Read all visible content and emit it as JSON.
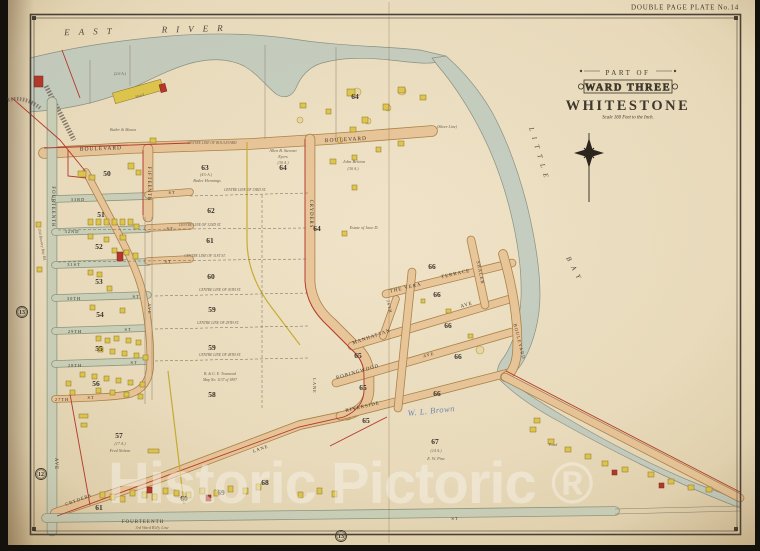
{
  "plate_label": "DOUBLE PAGE PLATE No.14",
  "title": {
    "part_of": "PART OF",
    "ward": "WARD THREE",
    "place": "WHITESTONE",
    "scale": "Scale 160 Feet to the Inch."
  },
  "water_labels": {
    "river": "EAST RIVER",
    "bay_word1": "LITTLE",
    "bay_word2": "BAY"
  },
  "annotation": {
    "handwriting": "W. L. Brown"
  },
  "watermark": "Historic Pictoric ®",
  "page_refs": [
    {
      "n": "13",
      "x": 22,
      "y": 312
    },
    {
      "n": "12",
      "x": 41,
      "y": 474
    },
    {
      "n": "13",
      "x": 341,
      "y": 536
    }
  ],
  "street_labels": [
    {
      "t": "BOULEVARD",
      "x": 101,
      "y": 150,
      "r": -2,
      "s": 5.5,
      "ls": 1.5
    },
    {
      "t": "BOULEVARD",
      "x": 346,
      "y": 141,
      "r": -3,
      "s": 5.5,
      "ls": 1.5
    },
    {
      "t": "FOURTEENTH",
      "x": 52,
      "y": 207,
      "r": 90,
      "s": 4.8
    },
    {
      "t": "AVE",
      "x": 55,
      "y": 464,
      "r": 90,
      "s": 4.8
    },
    {
      "t": "FIFTEENTH",
      "x": 148,
      "y": 184,
      "r": 90,
      "s": 4.8
    },
    {
      "t": "AVE",
      "x": 148,
      "y": 309,
      "r": 90,
      "s": 4.4
    },
    {
      "t": "CRYDERS",
      "x": 310,
      "y": 214,
      "r": 90,
      "s": 4.8
    },
    {
      "t": "LANE",
      "x": 313,
      "y": 386,
      "r": 90,
      "s": 4.4
    },
    {
      "t": "33RD",
      "x": 78,
      "y": 201,
      "s": 4.4
    },
    {
      "t": "ST",
      "x": 172,
      "y": 194,
      "s": 4.4
    },
    {
      "t": "32ND",
      "x": 72,
      "y": 233,
      "s": 4.4
    },
    {
      "t": "ST",
      "x": 170,
      "y": 230,
      "s": 4.4
    },
    {
      "t": "31ST",
      "x": 74,
      "y": 266,
      "s": 4.4
    },
    {
      "t": "ST",
      "x": 168,
      "y": 263,
      "s": 4.4
    },
    {
      "t": "30TH",
      "x": 74,
      "y": 300,
      "s": 4.4
    },
    {
      "t": "ST",
      "x": 136,
      "y": 298,
      "s": 4.4
    },
    {
      "t": "29TH",
      "x": 75,
      "y": 333,
      "s": 4.4
    },
    {
      "t": "ST",
      "x": 128,
      "y": 331,
      "s": 4.4
    },
    {
      "t": "28TH",
      "x": 75,
      "y": 367,
      "s": 4.4
    },
    {
      "t": "ST",
      "x": 134,
      "y": 364,
      "s": 4.4
    },
    {
      "t": "27TH",
      "x": 62,
      "y": 401,
      "s": 4.4
    },
    {
      "t": "ST",
      "x": 91,
      "y": 399,
      "s": 4.4
    },
    {
      "t": "FOURTEENTH",
      "x": 143,
      "y": 523,
      "s": 5,
      "ls": 1.5
    },
    {
      "t": "ST",
      "x": 455,
      "y": 520,
      "s": 4.6
    },
    {
      "t": "THE VERA",
      "x": 406,
      "y": 289,
      "r": -13
    },
    {
      "t": "TERRACE",
      "x": 456,
      "y": 275,
      "r": -13
    },
    {
      "t": "MANHATTAN",
      "x": 372,
      "y": 338,
      "r": -19
    },
    {
      "t": "AVE",
      "x": 467,
      "y": 306,
      "r": -17
    },
    {
      "t": "ROBINGWOOD",
      "x": 358,
      "y": 373,
      "r": -16
    },
    {
      "t": "AVE",
      "x": 429,
      "y": 356,
      "r": -16,
      "s": 4.4
    },
    {
      "t": "RIVERSIDE",
      "x": 363,
      "y": 408,
      "r": -13
    },
    {
      "t": "SHALER",
      "x": 479,
      "y": 273,
      "r": 78,
      "s": 4.6
    },
    {
      "t": "BOULEVARD",
      "x": 518,
      "y": 342,
      "r": 76,
      "s": 4.6
    },
    {
      "t": "26TH",
      "x": 388,
      "y": 307,
      "r": 78,
      "s": 4.2
    },
    {
      "t": "LANE",
      "x": 261,
      "y": 450,
      "r": -19,
      "s": 4.6
    },
    {
      "t": "CRYDERS",
      "x": 79,
      "y": 501,
      "r": -20,
      "s": 4.6
    }
  ],
  "block_labels": [
    {
      "n": "50",
      "x": 107,
      "y": 176
    },
    {
      "n": "51",
      "x": 101,
      "y": 217
    },
    {
      "n": "52",
      "x": 99,
      "y": 249
    },
    {
      "n": "53",
      "x": 99,
      "y": 284
    },
    {
      "n": "54",
      "x": 100,
      "y": 317
    },
    {
      "n": "55",
      "x": 99,
      "y": 351
    },
    {
      "n": "56",
      "x": 96,
      "y": 386
    },
    {
      "n": "57",
      "x": 119,
      "y": 438
    },
    {
      "n": "58",
      "x": 212,
      "y": 397
    },
    {
      "n": "59",
      "x": 212,
      "y": 350
    },
    {
      "n": "59",
      "x": 212,
      "y": 312
    },
    {
      "n": "60",
      "x": 211,
      "y": 279
    },
    {
      "n": "61",
      "x": 210,
      "y": 243
    },
    {
      "n": "62",
      "x": 211,
      "y": 213
    },
    {
      "n": "63",
      "x": 205,
      "y": 170
    },
    {
      "n": "64",
      "x": 283,
      "y": 170
    },
    {
      "n": "64",
      "x": 355,
      "y": 99
    },
    {
      "n": "64",
      "x": 317,
      "y": 231
    },
    {
      "n": "65",
      "x": 358,
      "y": 358
    },
    {
      "n": "65",
      "x": 363,
      "y": 390
    },
    {
      "n": "65",
      "x": 366,
      "y": 423
    },
    {
      "n": "66",
      "x": 432,
      "y": 269
    },
    {
      "n": "66",
      "x": 437,
      "y": 297
    },
    {
      "n": "66",
      "x": 448,
      "y": 328
    },
    {
      "n": "66",
      "x": 458,
      "y": 359
    },
    {
      "n": "66",
      "x": 437,
      "y": 396
    },
    {
      "n": "67",
      "x": 435,
      "y": 444
    },
    {
      "n": "68",
      "x": 265,
      "y": 485
    },
    {
      "n": "69",
      "x": 221,
      "y": 495
    },
    {
      "n": "60",
      "x": 184,
      "y": 501
    },
    {
      "n": "61",
      "x": 99,
      "y": 510
    }
  ],
  "notes": [
    {
      "t": "CENTRE LINE OF BOULEVARD",
      "x": 212,
      "y": 144,
      "s": 3.6
    },
    {
      "t": "CENTRE LINE OF 33RD ST.",
      "x": 245,
      "y": 191,
      "s": 3.6
    },
    {
      "t": "CENTRE LINE OF 32ND ST.",
      "x": 200,
      "y": 226,
      "s": 3.6
    },
    {
      "t": "CENTRE LINE OF 31ST ST.",
      "x": 205,
      "y": 257,
      "s": 3.6
    },
    {
      "t": "CENTRE LINE OF 30TH ST.",
      "x": 220,
      "y": 291,
      "s": 3.6
    },
    {
      "t": "CENTRE LINE OF 29TH ST.",
      "x": 218,
      "y": 324,
      "s": 3.6
    },
    {
      "t": "CENTRE LINE OF 28TH ST.",
      "x": 220,
      "y": 356,
      "s": 3.6
    },
    {
      "t": "(Shore Line)",
      "x": 447,
      "y": 128,
      "s": 4
    },
    {
      "t": "John Britton",
      "x": 354,
      "y": 163,
      "s": 4.5
    },
    {
      "t": "(30 A.)",
      "x": 353,
      "y": 170,
      "s": 4
    },
    {
      "t": "Allen B. Stewart",
      "x": 283,
      "y": 152,
      "s": 4.2
    },
    {
      "t": "Eyers",
      "x": 283,
      "y": 158,
      "s": 4.2
    },
    {
      "t": "(30 A.)",
      "x": 283,
      "y": 164,
      "s": 4
    },
    {
      "t": "(4½ A.)",
      "x": 206,
      "y": 176,
      "s": 4
    },
    {
      "t": "Butler Hennings",
      "x": 207,
      "y": 182,
      "s": 4.2
    },
    {
      "t": "(17 A.)",
      "x": 120,
      "y": 445,
      "s": 4
    },
    {
      "t": "Fred Nelson",
      "x": 120,
      "y": 452,
      "s": 4.2
    },
    {
      "t": "(14 A.)",
      "x": 436,
      "y": 452,
      "s": 4
    },
    {
      "t": "E. W. Pine",
      "x": 436,
      "y": 460,
      "s": 4.2
    },
    {
      "t": "Estate of Jane D.",
      "x": 364,
      "y": 229,
      "s": 4.2
    },
    {
      "t": "(2.6 A.)",
      "x": 120,
      "y": 75,
      "s": 4
    },
    {
      "t": "Hotel",
      "x": 140,
      "y": 97,
      "s": 4,
      "r": -17
    },
    {
      "t": "3rd Ward B'd'y Line",
      "x": 152,
      "y": 529,
      "s": 4.2
    },
    {
      "t": "Butler & Mason",
      "x": 123,
      "y": 131,
      "s": 4
    },
    {
      "t": "B. & G. E. Townsend",
      "x": 220,
      "y": 375,
      "s": 3.8
    },
    {
      "t": "Map No. 1137 of 1897",
      "x": 220,
      "y": 381,
      "s": 3.8
    },
    {
      "t": "Pond",
      "x": 553,
      "y": 446,
      "s": 4
    },
    {
      "t": "Old Bowery Bay Rd.",
      "x": 41,
      "y": 245,
      "s": 4,
      "r": 80
    }
  ],
  "buildings": [
    [
      113,
      86,
      50,
      11,
      "y",
      -16
    ],
    [
      34,
      76,
      9,
      11,
      "r"
    ],
    [
      160,
      84,
      6,
      8,
      "r",
      -15
    ],
    [
      78,
      171,
      8,
      6,
      "y"
    ],
    [
      89,
      175,
      6,
      5,
      "y"
    ],
    [
      128,
      163,
      6,
      6,
      "y"
    ],
    [
      136,
      170,
      5,
      5,
      "y"
    ],
    [
      150,
      138,
      6,
      5,
      "y"
    ],
    [
      88,
      219,
      5,
      6,
      "y"
    ],
    [
      96,
      219,
      5,
      6,
      "y"
    ],
    [
      104,
      219,
      5,
      6,
      "y"
    ],
    [
      112,
      219,
      5,
      6,
      "y"
    ],
    [
      120,
      219,
      5,
      6,
      "y"
    ],
    [
      128,
      219,
      5,
      6,
      "y"
    ],
    [
      134,
      224,
      5,
      5,
      "y"
    ],
    [
      88,
      234,
      5,
      5,
      "y"
    ],
    [
      104,
      237,
      5,
      5,
      "y"
    ],
    [
      120,
      235,
      6,
      5,
      "y"
    ],
    [
      112,
      248,
      5,
      5,
      "y"
    ],
    [
      124,
      250,
      5,
      5,
      "y"
    ],
    [
      133,
      253,
      5,
      6,
      "y"
    ],
    [
      117,
      252,
      6,
      9,
      "r"
    ],
    [
      88,
      270,
      5,
      5,
      "y"
    ],
    [
      97,
      272,
      5,
      5,
      "y"
    ],
    [
      107,
      286,
      5,
      5,
      "y"
    ],
    [
      90,
      305,
      5,
      5,
      "y"
    ],
    [
      120,
      308,
      5,
      5,
      "y"
    ],
    [
      96,
      336,
      5,
      5,
      "y"
    ],
    [
      105,
      338,
      5,
      5,
      "y"
    ],
    [
      114,
      336,
      5,
      5,
      "y"
    ],
    [
      126,
      338,
      5,
      5,
      "y"
    ],
    [
      136,
      340,
      5,
      5,
      "y"
    ],
    [
      98,
      347,
      5,
      5,
      "y"
    ],
    [
      110,
      349,
      5,
      5,
      "y"
    ],
    [
      122,
      351,
      5,
      5,
      "y"
    ],
    [
      134,
      353,
      5,
      5,
      "y"
    ],
    [
      143,
      355,
      5,
      5,
      "y"
    ],
    [
      80,
      372,
      5,
      5,
      "y"
    ],
    [
      92,
      374,
      5,
      5,
      "y"
    ],
    [
      104,
      376,
      5,
      5,
      "y"
    ],
    [
      116,
      378,
      5,
      5,
      "y"
    ],
    [
      128,
      380,
      5,
      5,
      "y"
    ],
    [
      140,
      382,
      5,
      5,
      "y"
    ],
    [
      96,
      388,
      5,
      5,
      "y"
    ],
    [
      110,
      390,
      5,
      5,
      "y"
    ],
    [
      124,
      392,
      5,
      5,
      "y"
    ],
    [
      138,
      394,
      5,
      5,
      "y"
    ],
    [
      66,
      381,
      5,
      5,
      "y"
    ],
    [
      70,
      390,
      5,
      5,
      "y"
    ],
    [
      79,
      414,
      9,
      4,
      "y"
    ],
    [
      81,
      423,
      6,
      4,
      "y"
    ],
    [
      148,
      449,
      11,
      4,
      "y"
    ],
    [
      100,
      492,
      5,
      6,
      "y"
    ],
    [
      110,
      494,
      5,
      6,
      "y"
    ],
    [
      120,
      496,
      5,
      6,
      "y"
    ],
    [
      130,
      490,
      5,
      6,
      "y"
    ],
    [
      142,
      492,
      5,
      6,
      "y"
    ],
    [
      152,
      494,
      5,
      6,
      "y"
    ],
    [
      163,
      488,
      5,
      6,
      "y"
    ],
    [
      174,
      490,
      5,
      6,
      "y"
    ],
    [
      186,
      492,
      5,
      6,
      "y"
    ],
    [
      200,
      488,
      5,
      6,
      "y"
    ],
    [
      214,
      490,
      5,
      6,
      "y"
    ],
    [
      228,
      486,
      5,
      6,
      "y"
    ],
    [
      243,
      488,
      5,
      6,
      "y"
    ],
    [
      256,
      484,
      5,
      6,
      "y"
    ],
    [
      147,
      487,
      5,
      6,
      "r"
    ],
    [
      206,
      495,
      5,
      6,
      "r"
    ],
    [
      298,
      492,
      5,
      6,
      "y"
    ],
    [
      317,
      488,
      5,
      6,
      "y"
    ],
    [
      332,
      491,
      5,
      6,
      "y"
    ],
    [
      347,
      89,
      8,
      7,
      "y"
    ],
    [
      362,
      117,
      6,
      6,
      "y"
    ],
    [
      398,
      87,
      7,
      6,
      "y"
    ],
    [
      420,
      95,
      6,
      5,
      "y"
    ],
    [
      383,
      104,
      6,
      6,
      "y"
    ],
    [
      326,
      109,
      5,
      5,
      "y"
    ],
    [
      300,
      103,
      6,
      5,
      "y"
    ],
    [
      350,
      127,
      6,
      5,
      "y"
    ],
    [
      330,
      159,
      6,
      5,
      "y"
    ],
    [
      352,
      155,
      5,
      5,
      "y"
    ],
    [
      376,
      147,
      5,
      5,
      "y"
    ],
    [
      398,
      141,
      6,
      5,
      "y"
    ],
    [
      352,
      185,
      5,
      5,
      "y"
    ],
    [
      342,
      231,
      5,
      5,
      "y"
    ],
    [
      446,
      309,
      5,
      4,
      "y"
    ],
    [
      468,
      334,
      5,
      4,
      "y"
    ],
    [
      421,
      299,
      4,
      4,
      "y"
    ],
    [
      530,
      427,
      6,
      5,
      "y"
    ],
    [
      548,
      439,
      6,
      5,
      "y"
    ],
    [
      565,
      447,
      6,
      5,
      "y"
    ],
    [
      585,
      454,
      6,
      5,
      "y"
    ],
    [
      602,
      461,
      6,
      5,
      "y"
    ],
    [
      622,
      467,
      6,
      5,
      "y"
    ],
    [
      648,
      472,
      6,
      5,
      "y"
    ],
    [
      668,
      479,
      6,
      5,
      "y"
    ],
    [
      688,
      485,
      6,
      5,
      "y"
    ],
    [
      612,
      470,
      5,
      5,
      "r"
    ],
    [
      659,
      483,
      5,
      5,
      "r"
    ],
    [
      534,
      418,
      6,
      5,
      "y"
    ],
    [
      706,
      487,
      6,
      5,
      "y"
    ],
    [
      36,
      222,
      5,
      5,
      "y"
    ],
    [
      37,
      267,
      5,
      5,
      "y"
    ]
  ],
  "trees": [
    [
      357,
      92,
      4
    ],
    [
      402,
      91,
      4
    ],
    [
      368,
      121,
      3
    ],
    [
      388,
      108,
      3
    ],
    [
      480,
      350,
      4
    ],
    [
      300,
      120,
      3
    ],
    [
      340,
      140,
      3
    ]
  ],
  "colors": {
    "water": "#c6cfc2",
    "road": "#e9c79b",
    "road_edge": "#ab8349",
    "green_road": "#ccd2bc",
    "green_edge": "#8d9881",
    "building_yellow": "#e0c84e",
    "building_yellow_edge": "#8a7425",
    "building_red": "#b5372b",
    "building_red_edge": "#7c2418",
    "ink": "#3d362c",
    "red_line": "#b5372b",
    "yellow_line": "#c9ad35"
  }
}
